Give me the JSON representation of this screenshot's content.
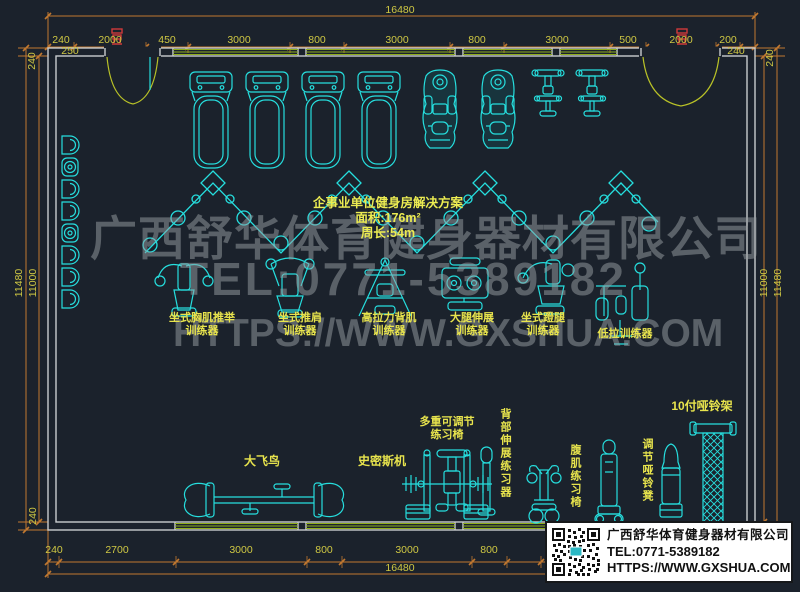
{
  "dimensions": {
    "top_total": "16480",
    "top_row": [
      "240",
      "2000",
      "450",
      "3000",
      "800",
      "3000",
      "800",
      "3000",
      "500",
      "2000",
      "200"
    ],
    "top_sub_left": "250",
    "top_sub_right": "240",
    "bottom_row": [
      "240",
      "2700",
      "3000",
      "800",
      "3000",
      "800"
    ],
    "bottom_total": "16480",
    "left_top": "240",
    "left_outer": "11480",
    "left_inner": "11000",
    "left_bottom": "240",
    "right_top": "240",
    "right_inner": "11000",
    "right_outer": "11480"
  },
  "plan_title": {
    "line1": "企事业单位健身房解决方案",
    "line2": "面积:176m²",
    "line3": "周长:54m"
  },
  "watermark": {
    "line1": "广西舒华体育健身器材有限公司",
    "line2": "TEL:0771-5389182",
    "line3": "HTTPS://WWW.GXSHUA.COM"
  },
  "equipment_labels": {
    "chest_press": "坐式胸肌推举\n训练器",
    "shoulder_press": "坐式推肩\n训练器",
    "lat_pulldown": "高拉力背肌\n训练器",
    "leg_extension": "大腿伸展\n训练器",
    "leg_press": "坐式蹬腿\n训练器",
    "low_row": "低拉训练器",
    "cable_crossover": "大飞鸟",
    "smith_machine": "史密斯机",
    "adjustable_bench": "多重可调节\n练习椅",
    "back_extension": "背部伸展练习器",
    "ab_bench": "腹肌练习椅",
    "dumbbell_stool": "调节哑铃凳",
    "dumbbell_rack": "10付哑铃架"
  },
  "info_box": {
    "company": "广西舒华体育健身器材有限公司",
    "tel": "TEL:0771-5389182",
    "url": "HTTPS://WWW.GXSHUA.COM"
  },
  "colors": {
    "background": "#1b222c",
    "equipment_cyan": "#26dede",
    "dimension_orange": "#c07830",
    "dim_text_yellow": "#cfc843",
    "label_yellow": "#e8e44d",
    "wall_white": "#c9ccce",
    "window_green": "#8fae1b",
    "door_green": "#b9c227",
    "watermark_gray": "#9aa0a4",
    "marker_red": "#cf3a3a"
  }
}
